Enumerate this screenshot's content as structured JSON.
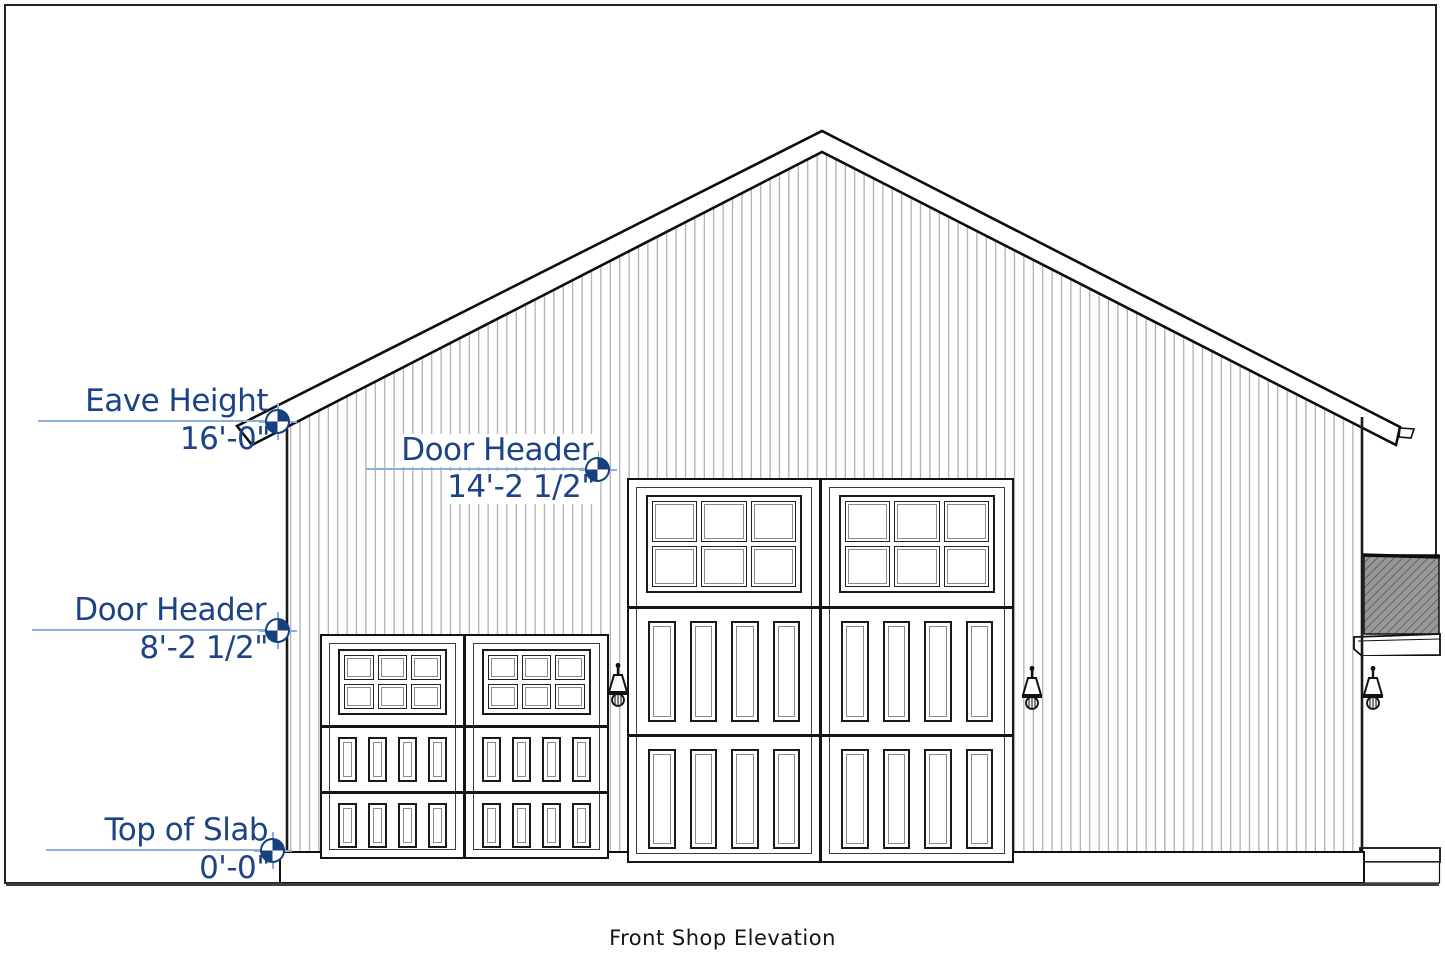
{
  "title": "Front Shop Elevation",
  "drawing": {
    "type": "architectural-elevation",
    "annotations": [
      {
        "id": "eave-height",
        "label": "Eave Height",
        "value": "16'-0\""
      },
      {
        "id": "door-header-main",
        "label": "Door Header",
        "value": "14'-2 1/2\""
      },
      {
        "id": "door-header-small",
        "label": "Door Header",
        "value": "8'-2 1/2\""
      },
      {
        "id": "top-of-slab",
        "label": "Top of Slab",
        "value": "0'-0\""
      }
    ],
    "features": {
      "garage_doors": [
        "small two-bay carriage door",
        "large two-bay carriage door"
      ],
      "wall_lights": 3,
      "side_wing": "attached lower roof at right"
    }
  },
  "icons": {
    "datum_marker": "elevation-datum-target",
    "wall_light": "gooseneck-wall-light"
  },
  "colors": {
    "annotation_text": "#1c4386",
    "leader_line": "#8bafd8",
    "linework": "#141414",
    "siding_line": "#a3a3a3",
    "wing_roof_fill": "#989898"
  }
}
